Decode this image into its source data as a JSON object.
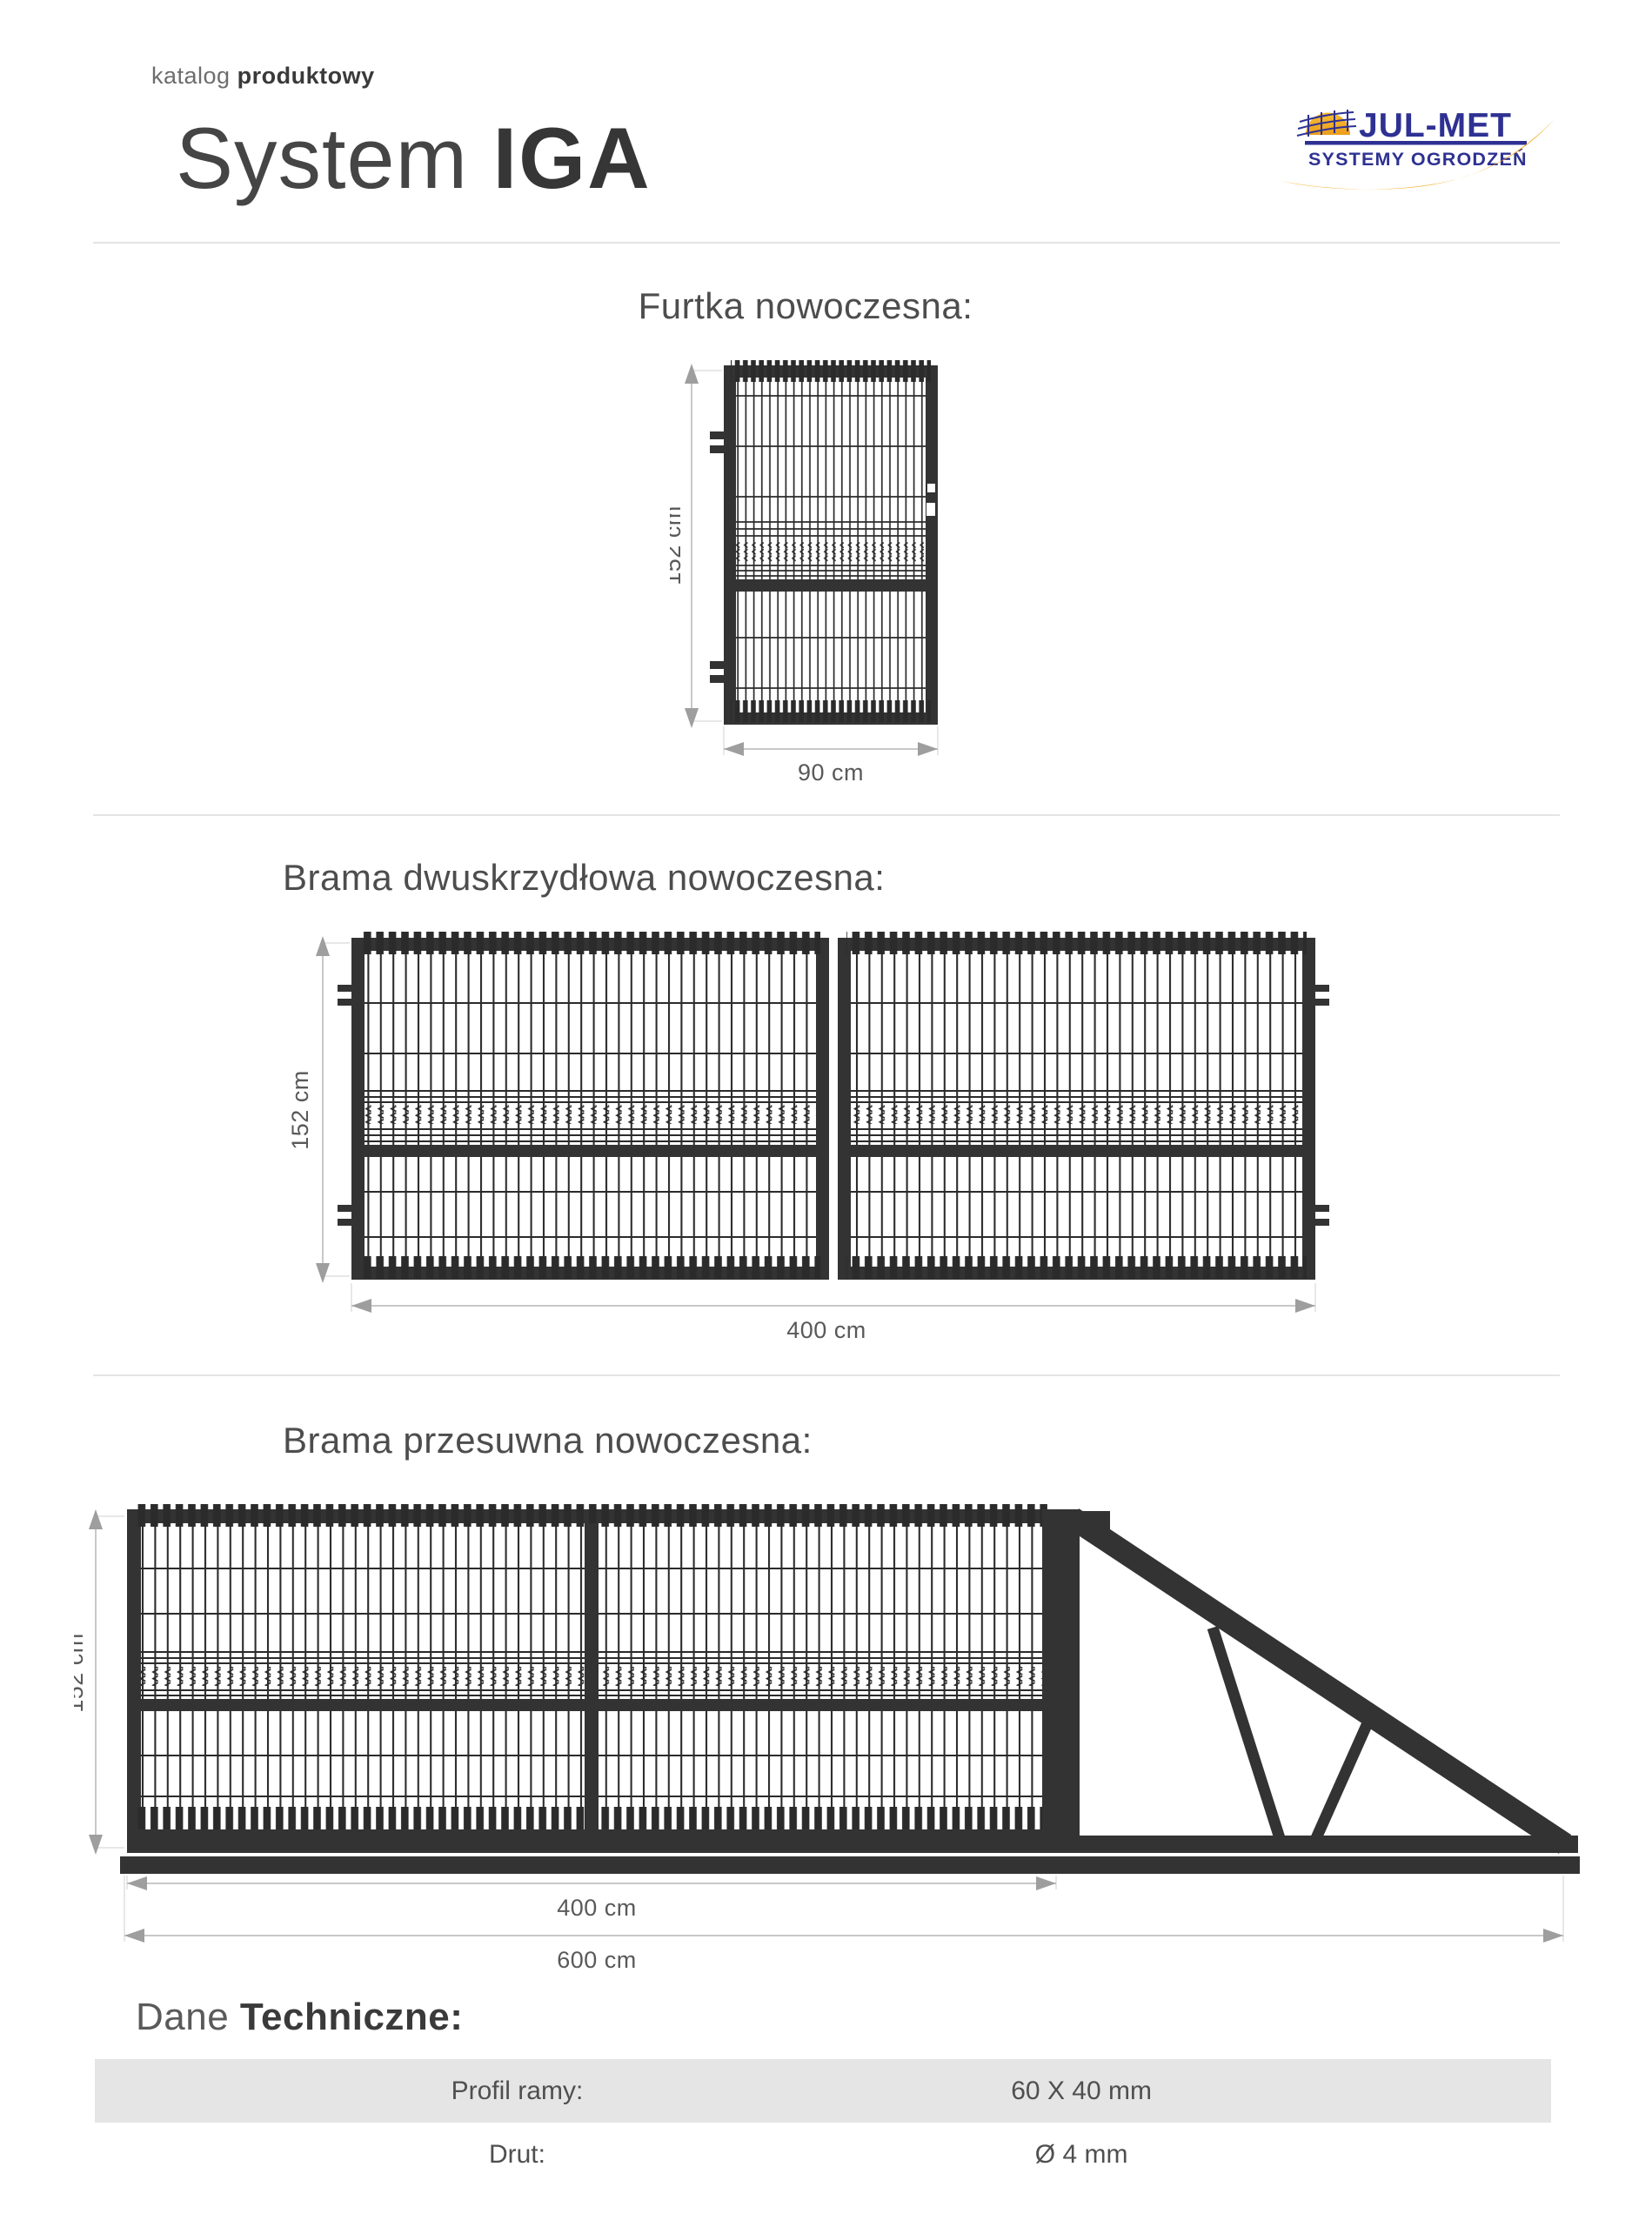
{
  "page": {
    "eyebrow_light": "katalog",
    "eyebrow_bold": "produktowy",
    "title_light": "System",
    "title_bold": "IGA"
  },
  "logo": {
    "brand": "JUL-MET",
    "tagline": "SYSTEMY OGRODZEŃ"
  },
  "sections": {
    "furtka": {
      "heading": "Furtka nowoczesna:",
      "height_dim": "152 cm",
      "width_dim": "90 cm"
    },
    "dwuskrzydlowa": {
      "heading": "Brama dwuskrzydłowa nowoczesna:",
      "height_dim": "152 cm",
      "width_dim": "400 cm"
    },
    "przesuwna": {
      "heading": "Brama przesuwna nowoczesna:",
      "height_dim": "152 cm",
      "width_dim_gate": "400 cm",
      "width_dim_total": "600 cm"
    }
  },
  "tech": {
    "heading_light": "Dane",
    "heading_bold": "Techniczne:",
    "rows": [
      {
        "label": "Profil ramy:",
        "value": "60 X 40 mm"
      },
      {
        "label": "Drut:",
        "value": "Ø 4 mm"
      }
    ]
  },
  "colors": {
    "frame_dark": "#333333",
    "logo_navy": "#2e3192",
    "logo_yellow": "#f3a81d",
    "dimension_gray": "#9e9e9e",
    "divider_gray": "#e4e4e4",
    "table_row_gray": "#e5e5e5"
  }
}
